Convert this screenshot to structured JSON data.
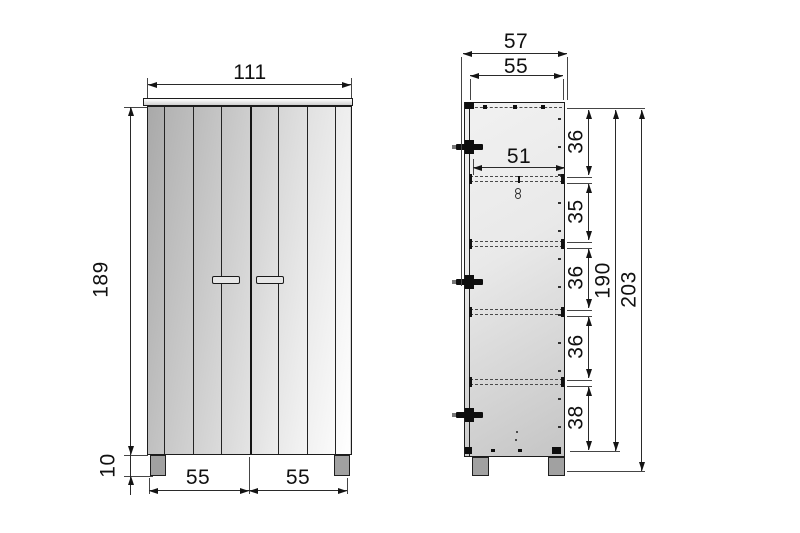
{
  "drawing": {
    "type": "furniture-technical-drawing",
    "front_view": {
      "width": "111",
      "height": "189",
      "leg_height": "10",
      "door_left_width": "55",
      "door_right_width": "55"
    },
    "side_view": {
      "depth": "57",
      "top_depth": "55",
      "shelf_depth": "51",
      "compartment_heights": [
        "36",
        "35",
        "36",
        "36",
        "38"
      ],
      "carcass_height": "190",
      "total_height": "203"
    },
    "colors": {
      "line": "#1c1c1c",
      "panel_light": "#f1f1f1",
      "panel_dark": "#c5c5c5",
      "leg": "#a1a1a1",
      "background": "#ffffff"
    }
  }
}
